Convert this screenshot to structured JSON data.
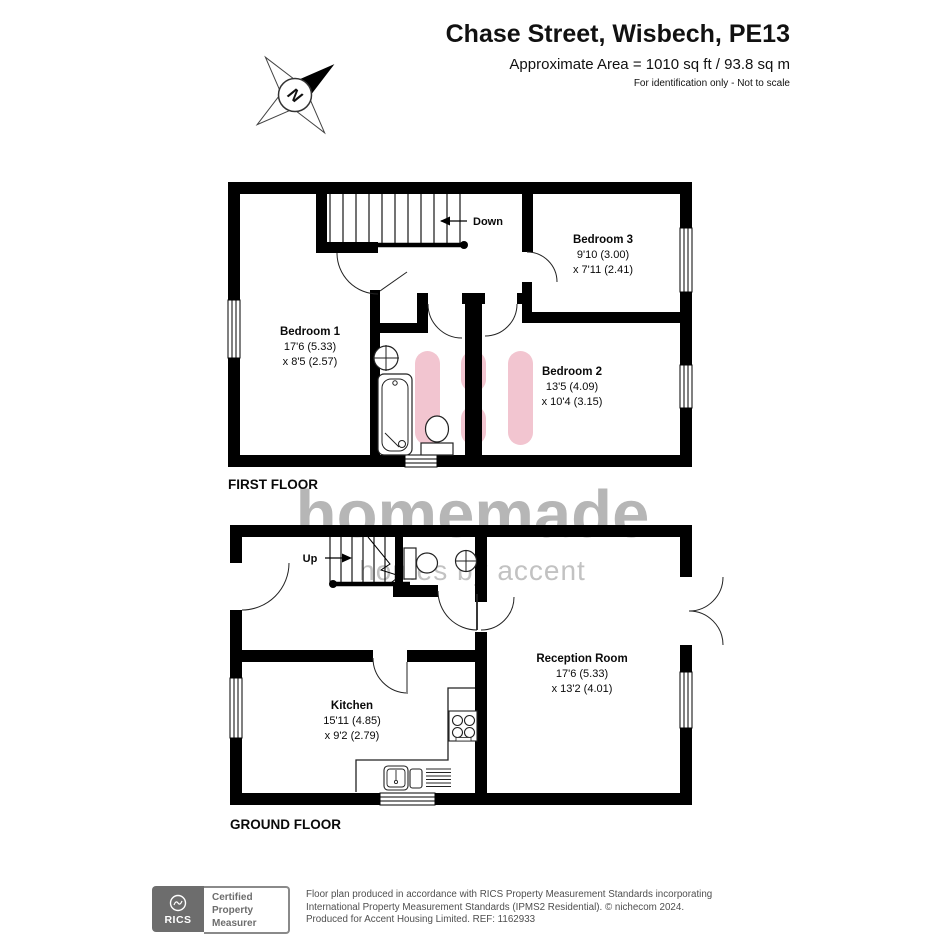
{
  "header": {
    "title": "Chase Street, Wisbech, PE13",
    "area": "Approximate Area = 1010 sq ft / 93.8 sq m",
    "disclaimer": "For identification only - Not to scale"
  },
  "compass": {
    "letter": "N"
  },
  "watermark": {
    "name": "homemade",
    "tagline": "homes by accent"
  },
  "floors": {
    "first": {
      "label": "FIRST FLOOR",
      "stair_label": "Down",
      "rooms": {
        "bedroom1": {
          "name": "Bedroom 1",
          "dim1": "17'6 (5.33)",
          "dim2": "x 8'5 (2.57)"
        },
        "bedroom3": {
          "name": "Bedroom 3",
          "dim1": "9'10 (3.00)",
          "dim2": "x 7'11 (2.41)"
        },
        "bedroom2": {
          "name": "Bedroom 2",
          "dim1": "13'5 (4.09)",
          "dim2": "x 10'4 (3.15)"
        }
      }
    },
    "ground": {
      "label": "GROUND FLOOR",
      "stair_label": "Up",
      "rooms": {
        "kitchen": {
          "name": "Kitchen",
          "dim1": "15'11 (4.85)",
          "dim2": "x 9'2 (2.79)"
        },
        "reception": {
          "name": "Reception Room",
          "dim1": "17'6 (5.33)",
          "dim2": "x 13'2 (4.01)"
        }
      }
    }
  },
  "footer": {
    "rics": "RICS",
    "certification": [
      "Certified",
      "Property",
      "Measurer"
    ],
    "line1": "Floor plan produced in accordance with RICS Property Measurement Standards incorporating",
    "line2": "International Property Measurement Standards (IPMS2 Residential).   © nichecom 2024.",
    "line3": "Produced for Accent Housing Limited.   REF:  1162933"
  },
  "colors": {
    "wall": "#000000",
    "logo_pink": "#f2c5d0",
    "watermark_name": "#b6b6b6",
    "watermark_tagline": "#c2c2c2"
  }
}
